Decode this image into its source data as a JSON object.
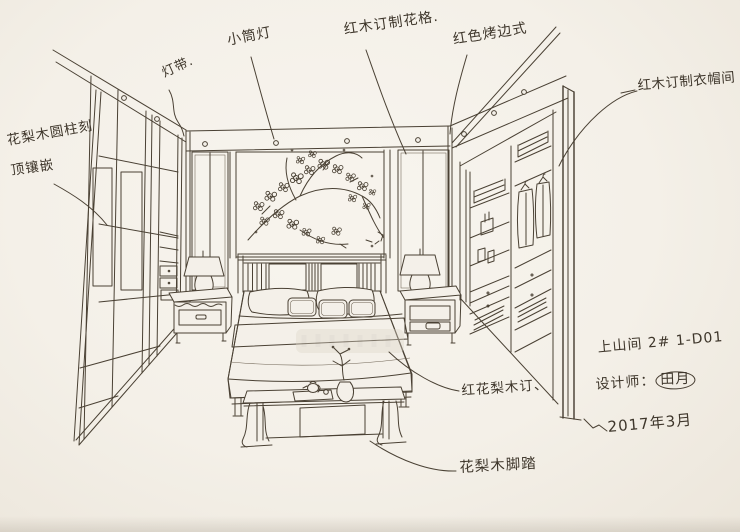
{
  "image_type": "hand-drawn interior design sketch of a Chinese-style bedroom",
  "colors": {
    "paper": "#f4f0e9",
    "ink": "#4a4134"
  },
  "annotations": {
    "wall_panel_line1": "花梨木圆柱刻",
    "wall_panel_line2": "顶镶嵌",
    "light_strip": "灯带.",
    "downlight": "小筒灯",
    "lattice": "红木订制花格.",
    "ceiling_edge": "红色烤边式",
    "cloakroom": "红木订制衣帽间",
    "bed": "红花梨木订、",
    "footstool": "花梨木脚踏"
  },
  "title_block": {
    "project_no": "上山间 2# 1-D01",
    "designer_label": "设计师：",
    "designer_name": "田月",
    "date": "2017年3月"
  }
}
